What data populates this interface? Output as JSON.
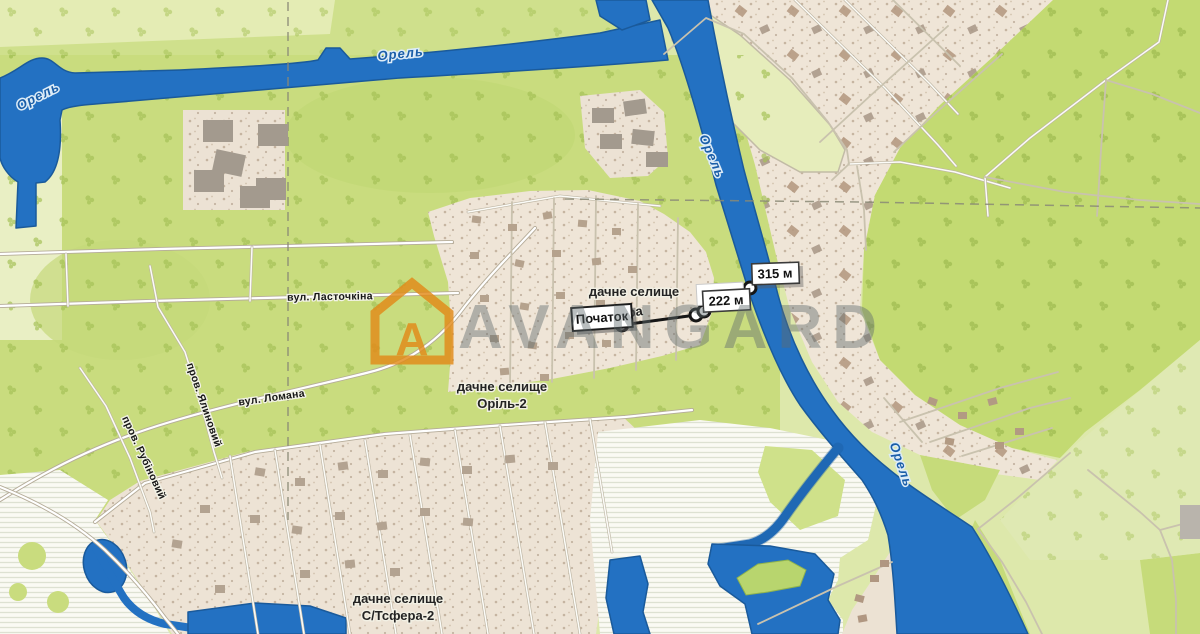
{
  "watermark": {
    "brand": "AVANGARD",
    "logo_letter": "A",
    "brand_color": "#e28a18"
  },
  "river_labels": [
    {
      "text": "Орель"
    },
    {
      "text": "Орель"
    },
    {
      "text": "Орель"
    },
    {
      "text": "Орель"
    }
  ],
  "streets": [
    {
      "id": "lastochkina",
      "label": "вул. Ласточкіна"
    },
    {
      "id": "lomana",
      "label": "вул. Ломана"
    },
    {
      "id": "yalynovyi",
      "label": "пров. Ялиновий"
    },
    {
      "id": "rubinovyi",
      "label": "пров. Рубіновий"
    }
  ],
  "settlements": [
    {
      "line1": "дачне селище",
      "line2": "Сфера"
    },
    {
      "line1": "дачне селище",
      "line2": "Оріль-2"
    },
    {
      "line1": "дачне селище",
      "line2": "С/Тсфера-2"
    }
  ],
  "measurement": {
    "start": "Початок",
    "d1": "222 м",
    "d2": "315 м"
  },
  "colors": {
    "water": "#2371c2",
    "field": "#c9dc7e",
    "settlement": "#efe5d7"
  }
}
